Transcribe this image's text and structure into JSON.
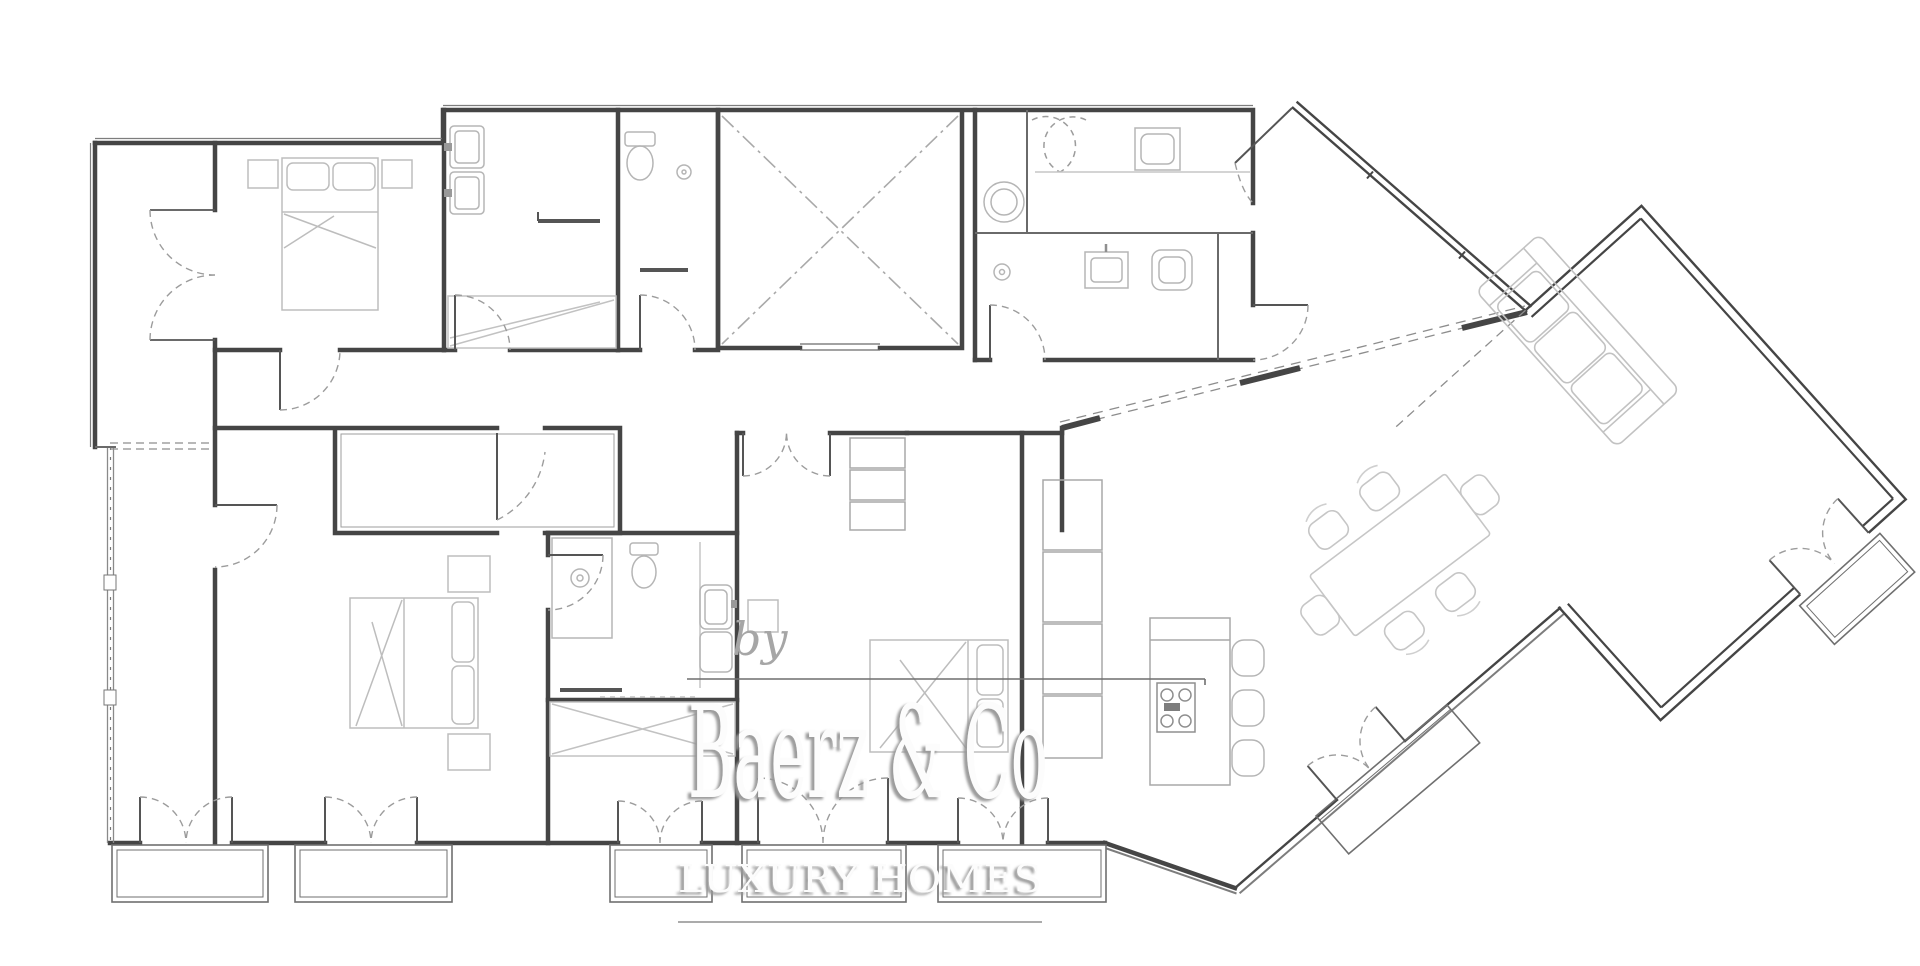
{
  "watermark": {
    "prefix": "by",
    "brand": "Baerz & Co",
    "tagline": "LUXURY HOMES"
  },
  "palette": {
    "background": "#ffffff",
    "wall_dark": "#454545",
    "wall_medium": "#6a6a6a",
    "wall_thin": "#8a8a8a",
    "furniture_light": "#bdbdbd",
    "furniture_lighter": "#c9c9c9",
    "door_arc": "#9c9c9c",
    "elevator_cross": "#a9a9a9",
    "watermark_fill": "#fcfcfc",
    "watermark_shadow": "#969696",
    "watermark_gray": "#a6a6a6",
    "rule_line": "#6f6f6f"
  },
  "drawing": {
    "type": "apartment-floor-plan",
    "rooms": [
      "bedroom-1",
      "closet-strip",
      "bathroom-1",
      "wc",
      "elevator-shaft",
      "bathroom-suite",
      "hall",
      "entry",
      "bedroom-2",
      "bathroom-2",
      "bedroom-3",
      "kitchen",
      "dining-area",
      "living-room",
      "balconies"
    ]
  }
}
